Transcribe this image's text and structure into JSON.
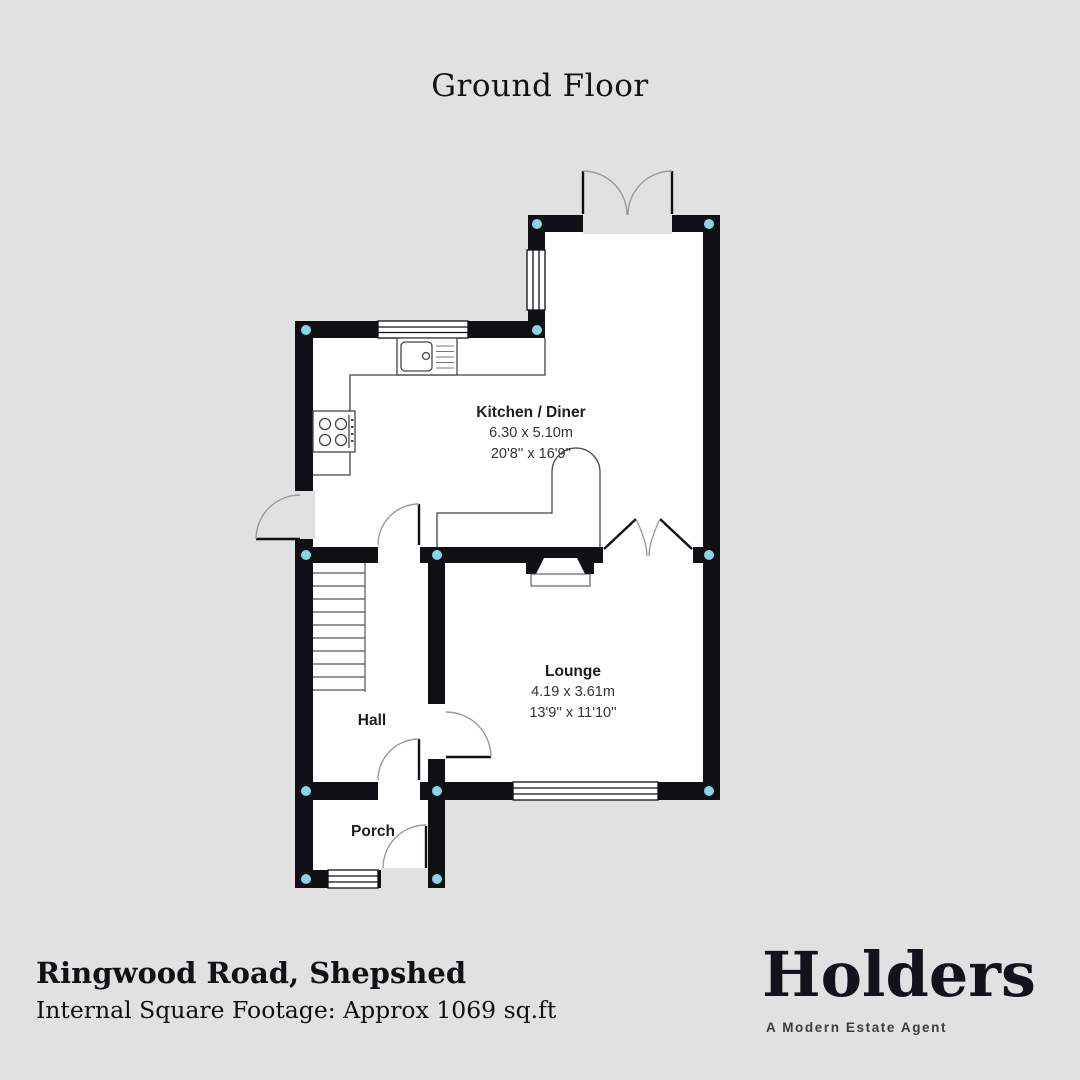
{
  "title": "Ground Floor",
  "rooms": {
    "kitchen": {
      "name": "Kitchen / Diner",
      "metric": "6.30 x 5.10m",
      "imperial": "20'8'' x 16'9''"
    },
    "lounge": {
      "name": "Lounge",
      "metric": "4.19 x 3.61m",
      "imperial": "13'9'' x 11'10''"
    },
    "hall": {
      "name": "Hall"
    },
    "porch": {
      "name": "Porch"
    }
  },
  "footer": {
    "address": "Ringwood Road, Shepshed",
    "square_footage": "Internal Square Footage: Approx 1069 sq.ft"
  },
  "brand": {
    "name": "Holders",
    "tagline": "A Modern Estate Agent"
  },
  "colors": {
    "background": "#e1e1e1",
    "wall": "#101014",
    "corner_marker": "#8bd3e6"
  }
}
